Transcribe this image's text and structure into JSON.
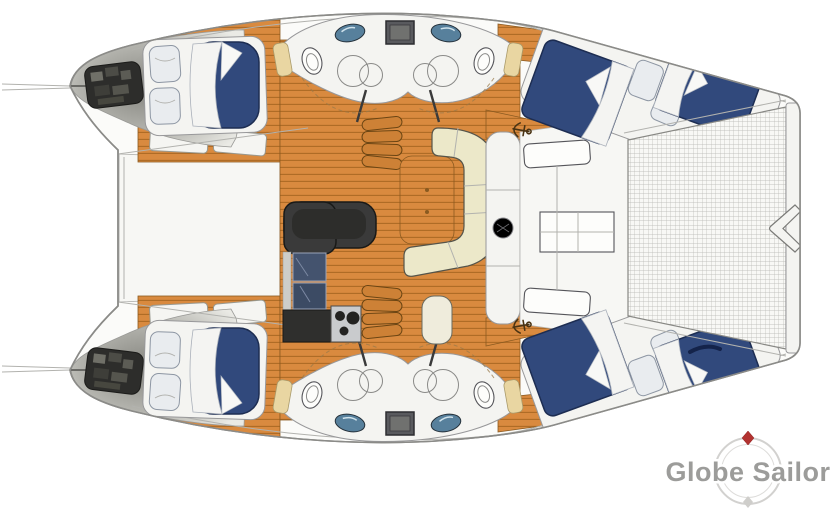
{
  "page": {
    "width": 831,
    "height": 516,
    "background": "#ffffff"
  },
  "diagram": {
    "kind": "catamaran-deck-floor-plan",
    "areas": [
      "forward-double-cabin-upper",
      "forward-double-cabin-lower",
      "aft-double-cabin-upper",
      "aft-double-cabin-lower",
      "bathroom-upper",
      "bathroom-lower",
      "galley",
      "dinette-with-sofa",
      "companionway-steps-upper",
      "companionway-steps-lower",
      "cockpit-benches-and-table",
      "stern-platform-net",
      "engine-compartment-upper",
      "engine-compartment-lower",
      "bridge-deck"
    ]
  },
  "logo": {
    "text": "Globe Sailor"
  },
  "palette": {
    "hullFill": "#fbfbf9",
    "hullStroke": "#8b8b88",
    "wood": "#d98a3f",
    "woodLine": "#ad6a24",
    "woodEdge": "#8a5a20",
    "bed": "#31497c",
    "bedStroke": "#1d2d52",
    "linen": "#f4f4f2",
    "pillow": "#e9ecef",
    "sofa": "#ece8c9",
    "counter": "#3a3a3a",
    "sink": "#57809c",
    "applianceBlue": "#44536e",
    "stove": "#c9cbcd",
    "meshLine": "#b5b5b0",
    "deckWhite": "#f4f4f1",
    "creamCap": "#e9d6a2",
    "logoGray": "#9c9c9a",
    "compassRing": "#d2d1cf",
    "compassRed": "#b23230"
  }
}
